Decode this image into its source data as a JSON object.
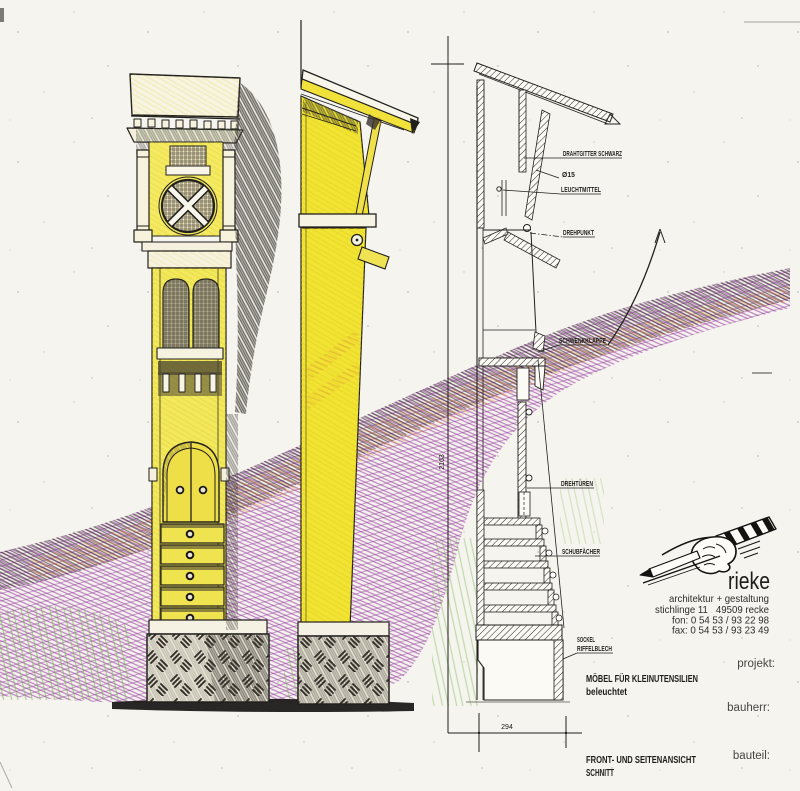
{
  "drawing": {
    "annotations": {
      "drahtgitter": "DRAHTGITTER SCHWARZ",
      "durchmesser": "Ø15",
      "leuchtmittel": "LEUCHTMITTEL",
      "drehpunkt": "DREHPUNKT",
      "schwenkklappe": "SCHWENKKLAPPE",
      "drehtueren": "DREHTÜREN",
      "schubfaecher": "SCHUBFÄCHER",
      "sockel_line1": "SOCKEL",
      "sockel_line2": "RIFFELBLECH"
    },
    "dimensions": {
      "height_mm": "2163",
      "width_mm": "294"
    },
    "captions": {
      "object_title": "MÖBEL FÜR KLEINUTENSILIEN",
      "object_subtitle": "beleuchtet",
      "view_title": "FRONT- UND SEITENANSICHT",
      "view_subtitle": "SCHNITT"
    },
    "title_block": {
      "firm": "rieke",
      "tagline": "architektur + gestaltung",
      "address": "stichlinge 11   49509 recke",
      "phone": "fon: 0 54 53 / 93 22 98",
      "fax": "fax: 0 54 53 / 93 23 49",
      "field_project": "projekt:",
      "field_client": "bauherr:",
      "field_part": "bauteil:"
    },
    "colors": {
      "paper": "#f6f4ee",
      "ink": "#1f1d1a",
      "pencil_yellow": "#f2e43c",
      "pencil_purple": "#a653b0",
      "pencil_orange": "#dc9433",
      "pencil_green": "#77b654",
      "pencil_shadow": "#35312c"
    }
  }
}
